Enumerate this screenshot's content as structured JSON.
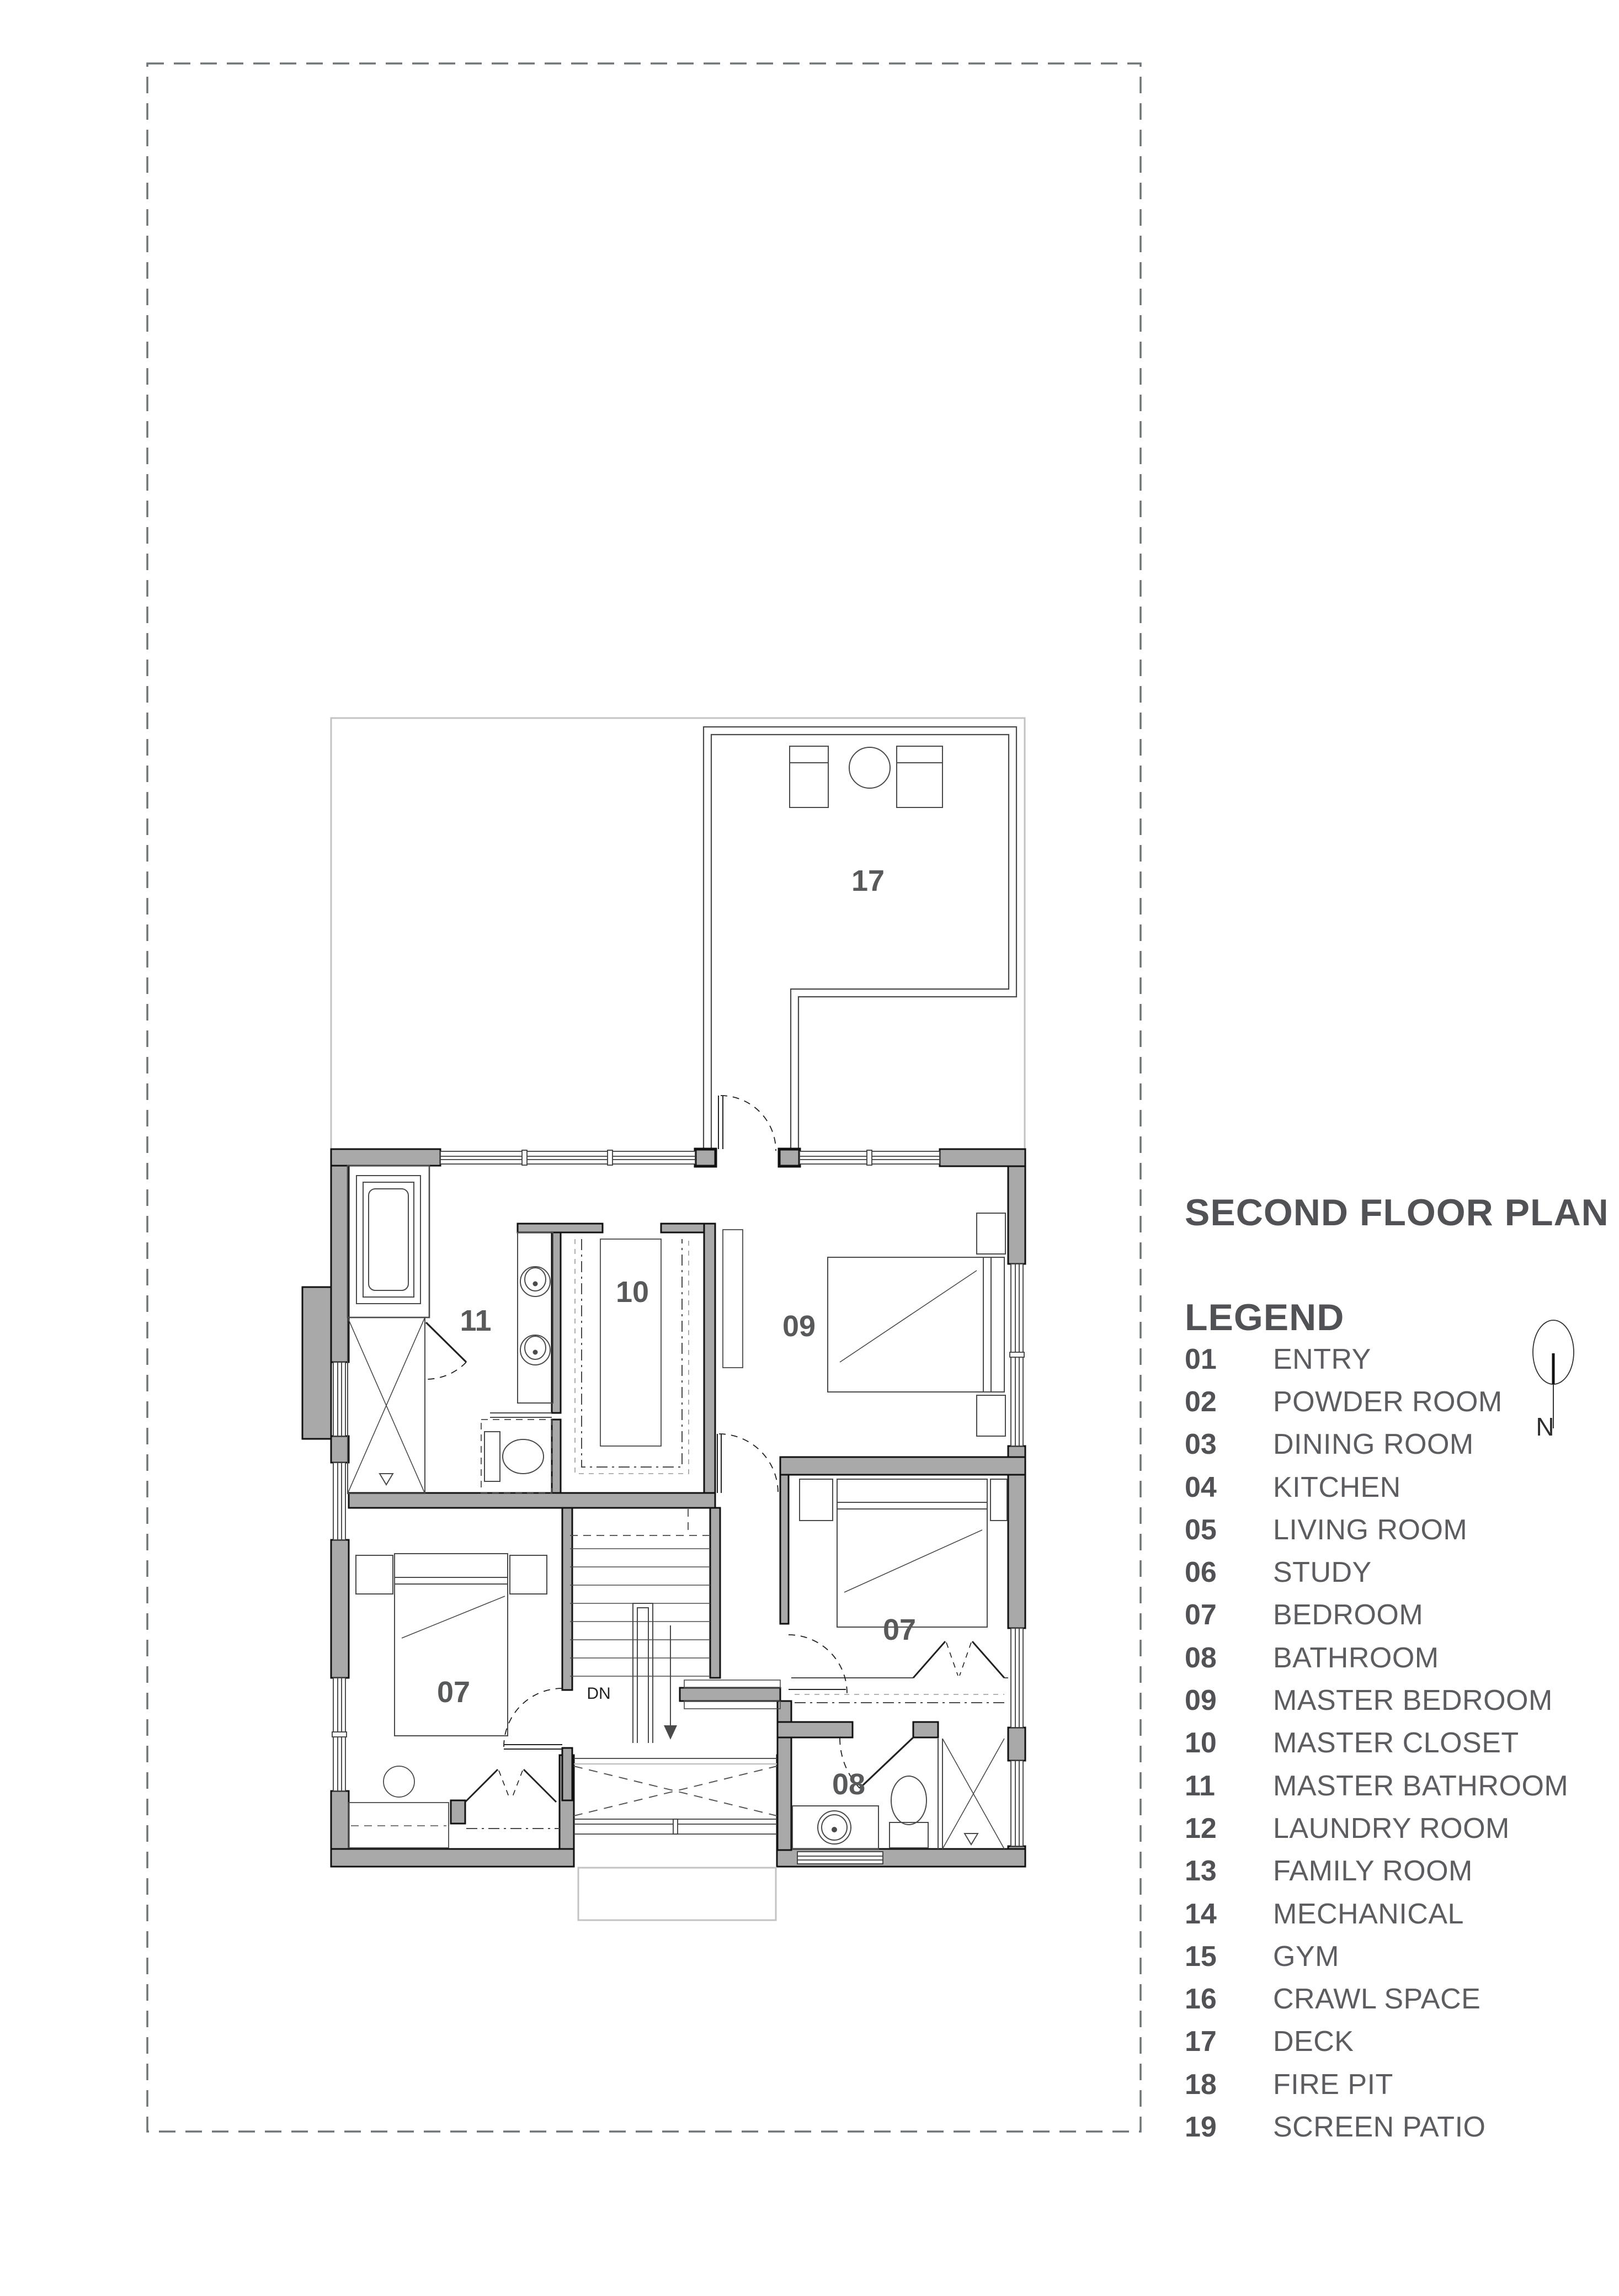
{
  "title": "SECOND FLOOR PLAN",
  "legend": {
    "heading": "LEGEND",
    "items": [
      {
        "num": "01",
        "label": "ENTRY"
      },
      {
        "num": "02",
        "label": "POWDER ROOM"
      },
      {
        "num": "03",
        "label": "DINING ROOM"
      },
      {
        "num": "04",
        "label": "KITCHEN"
      },
      {
        "num": "05",
        "label": "LIVING ROOM"
      },
      {
        "num": "06",
        "label": "STUDY"
      },
      {
        "num": "07",
        "label": "BEDROOM"
      },
      {
        "num": "08",
        "label": "BATHROOM"
      },
      {
        "num": "09",
        "label": "MASTER BEDROOM"
      },
      {
        "num": "10",
        "label": "MASTER CLOSET"
      },
      {
        "num": "11",
        "label": "MASTER BATHROOM"
      },
      {
        "num": "12",
        "label": "LAUNDRY ROOM"
      },
      {
        "num": "13",
        "label": "FAMILY ROOM"
      },
      {
        "num": "14",
        "label": "MECHANICAL"
      },
      {
        "num": "15",
        "label": "GYM"
      },
      {
        "num": "16",
        "label": "CRAWL SPACE"
      },
      {
        "num": "17",
        "label": "DECK"
      },
      {
        "num": "18",
        "label": "FIRE PIT"
      },
      {
        "num": "19",
        "label": "SCREEN PATIO"
      }
    ]
  },
  "north": {
    "label": "N"
  },
  "plan": {
    "labels": {
      "deck": "17",
      "master_bathroom": "11",
      "master_closet": "10",
      "master_bedroom": "09",
      "bedroom_right": "07",
      "bedroom_left": "07",
      "bathroom": "08",
      "stairs_down": "DN"
    }
  },
  "colors": {
    "text": "#515255",
    "label_text": "#5c5d60",
    "wall_fill": "#a9a9a9",
    "wall_edge": "#111111",
    "thin_line": "#3c3c3c",
    "light_line": "#c3c3c3",
    "dash_line": "#707477"
  }
}
